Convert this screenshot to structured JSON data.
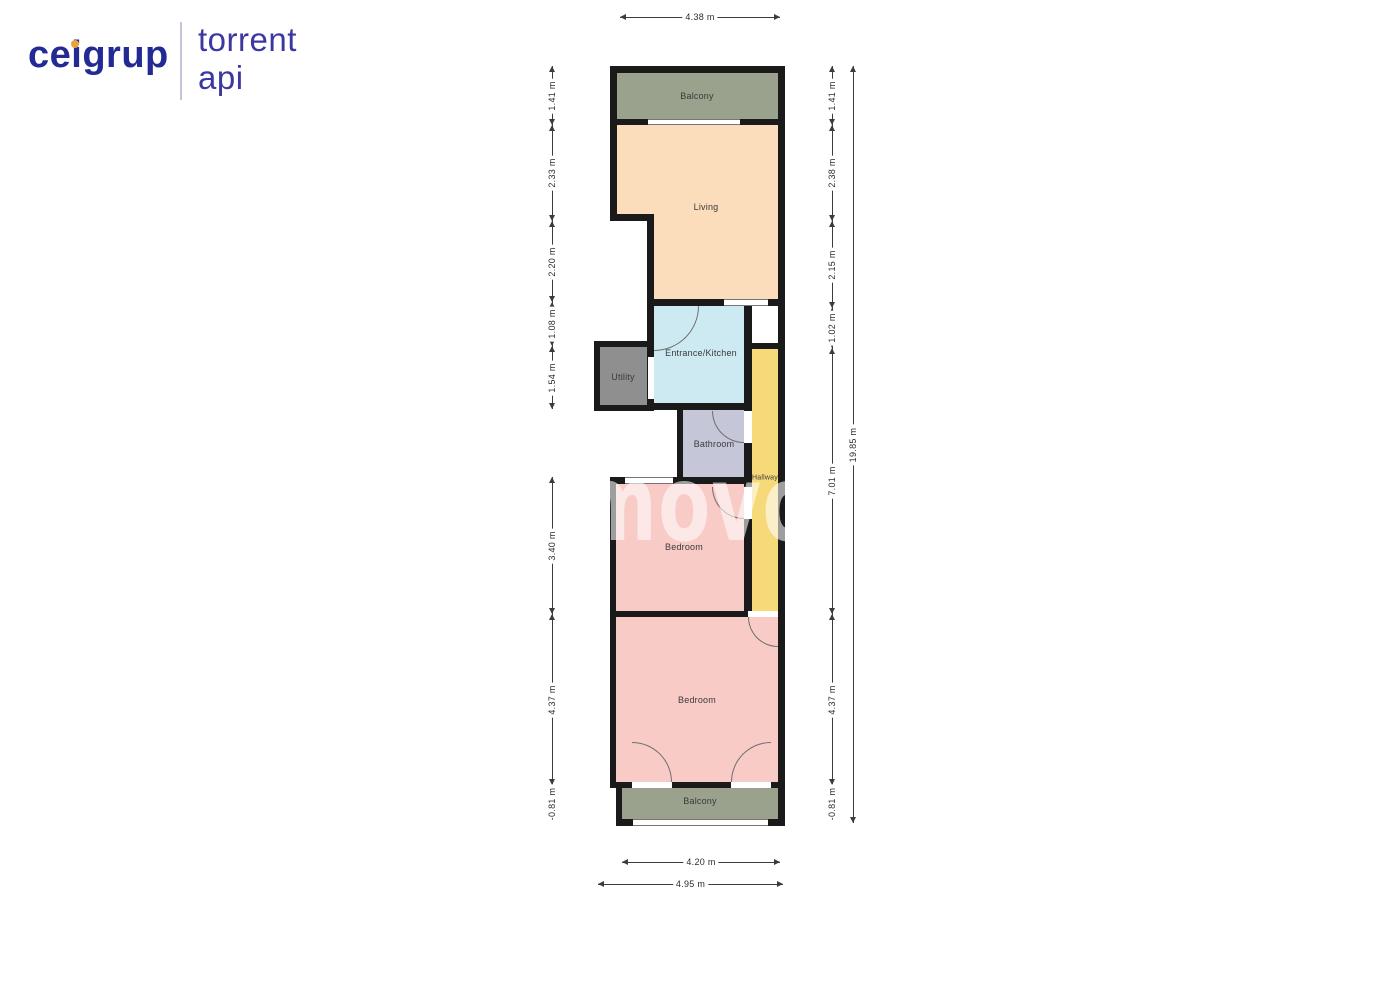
{
  "logo": {
    "brand_pre": "ce",
    "brand_i": "i",
    "brand_post": "grup",
    "brand_color": "#232a93",
    "dot_color": "#e8a33d",
    "divider_color": "#c3c6d8",
    "name_line1": "torrent",
    "name_line2": "api",
    "name_color": "#3b38a2"
  },
  "floorplan": {
    "watermark": "movo",
    "wall_color": "#1a1a1a",
    "rooms": [
      {
        "name": "Balcony",
        "color": "#9aa18c"
      },
      {
        "name": "Living",
        "color": "#fbdcbb"
      },
      {
        "name": "Entrance/Kitchen",
        "color": "#cdeaf3"
      },
      {
        "name": "Utility",
        "color": "#8f8f8f"
      },
      {
        "name": "Bathroom",
        "color": "#c6c6d9"
      },
      {
        "name": "Hallway",
        "color": "#f6da7a"
      },
      {
        "name": "Bedroom",
        "color": "#f8cbc7"
      },
      {
        "name": "Bedroom",
        "color": "#f8cbc7"
      },
      {
        "name": "Balcony",
        "color": "#9aa18c"
      }
    ],
    "dims_left": [
      "1.41 m",
      "2.33 m",
      "2.20 m",
      "1.08 m",
      "1.54 m",
      "3.40 m",
      "4.37 m",
      "-0.81 m"
    ],
    "dims_right": [
      "1.41 m",
      "2.38 m",
      "2.15 m",
      "1.02 m",
      "7.01 m",
      "4.37 m",
      "-0.81 m"
    ],
    "dim_right_total": "19.85 m",
    "dim_top": "4.38 m",
    "dim_bottom_inner": "4.20 m",
    "dim_bottom_outer": "4.95 m"
  }
}
